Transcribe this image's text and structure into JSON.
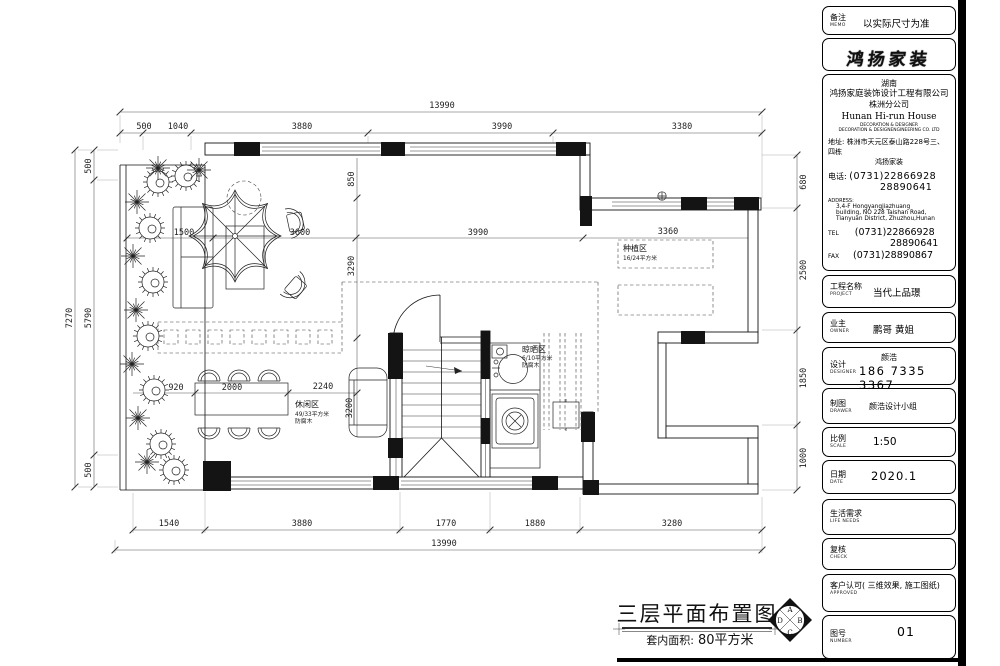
{
  "plan": {
    "dims": {
      "top_total": "13990",
      "top": [
        "500",
        "1040",
        "3880",
        "3990",
        "3380"
      ],
      "bottom": [
        "1540",
        "3880",
        "1770",
        "1880",
        "3280"
      ],
      "bottom_total": "13990",
      "left_total": "7270",
      "left": [
        "500",
        "5790",
        "500"
      ],
      "right": [
        "680",
        "2500",
        "1850",
        "1000"
      ],
      "inner": [
        "1500",
        "3600",
        "3990",
        "3360"
      ],
      "inner_v": [
        "850",
        "3290"
      ],
      "dining": [
        "920",
        "2000",
        "2240",
        "3200"
      ]
    },
    "zones": {
      "planting": {
        "name": "种植区",
        "size": "16/24平方米"
      },
      "drying": {
        "name": "晾晒区",
        "size": "6/10平方米",
        "note": "防腐木"
      },
      "leisure": {
        "name": "休闲区",
        "size": "49/33平方米",
        "note": "防腐木"
      }
    },
    "title": {
      "main": "三层平面布置图",
      "area_label": "套内面积:",
      "area_value": "80平方米"
    },
    "compass": {
      "n": "A",
      "e": "B",
      "s": "C",
      "w": "D"
    }
  },
  "sheet": {
    "memo": {
      "label": "备注",
      "en": "MEMO",
      "value": "以实际尺寸为准"
    },
    "logo": "鸿扬家装",
    "company": {
      "region": "湖南",
      "name": "鸿扬家庭装饰设计工程有限公司",
      "branch": "株洲分公司",
      "name_en": "Hunan  Hi-run  House",
      "line_en1": "DECORATION & DESIGNER",
      "line_en2": "DECORATION & DESIGNENGINEERING CO. LTD",
      "addr_label": "地址:",
      "addr1": "株洲市天元区泰山路228号三、四栋",
      "addr2": "鸿扬家装",
      "tel_label": "电话:",
      "tel1": "(0731)22866928",
      "tel2": "28890641",
      "address_label": "ADDRESS:",
      "address1": "3,4-F Hongyangjiazhuang",
      "address2": "building, NO 228 Taishan Road,",
      "address3": "Tianyuan District, Zhuzhou,Hunan",
      "tel_en": "TEL",
      "fax_en": "FAX",
      "fax": "(0731)28890867"
    },
    "project": {
      "label": "工程名称",
      "en": "PROJECT",
      "value": "当代上品璟"
    },
    "owner": {
      "label": "业主",
      "en": "OWNER",
      "value": "鹏哥  黄姐"
    },
    "designer": {
      "label": "设计",
      "en": "DESIGNER",
      "name": "颜浩",
      "phone": "186 7335 3367"
    },
    "drawer": {
      "label": "制图",
      "en": "DRAWER",
      "value": "颜浩设计小组"
    },
    "scale": {
      "label": "比例",
      "en": "SCALE",
      "value": "1:50"
    },
    "date": {
      "label": "日期",
      "en": "DATE",
      "value": "2020.1"
    },
    "life": {
      "label": "生活需求",
      "en": "LIFE  NEEDS"
    },
    "check": {
      "label": "复核",
      "en": "CHECK"
    },
    "approved": {
      "label": "客户认可( 三维效果, 施工图纸)",
      "en": "APPROVED"
    },
    "number": {
      "label": "图号",
      "en": "NUMBER",
      "value": "01"
    }
  }
}
